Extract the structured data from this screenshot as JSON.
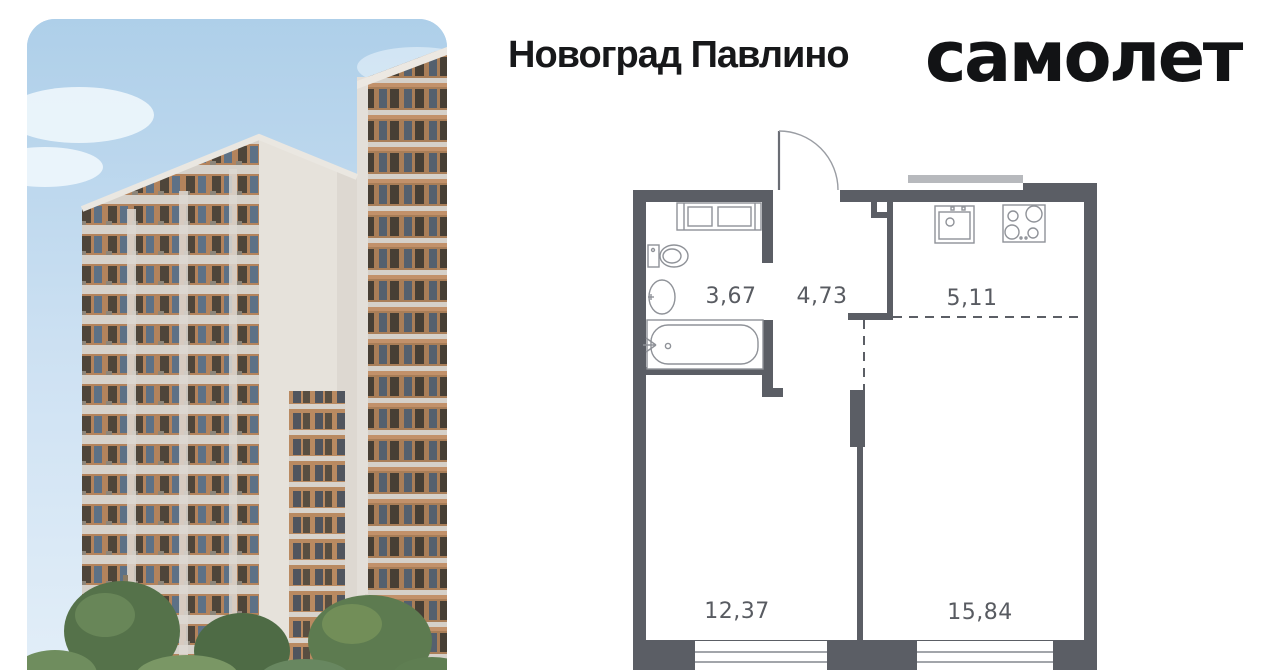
{
  "header": {
    "project_title": "Новоград Павлино",
    "brand_logo": "самолет"
  },
  "floorplan": {
    "rooms": [
      {
        "name": "bathroom",
        "area": "3,67"
      },
      {
        "name": "hallway",
        "area": "4,73"
      },
      {
        "name": "kitchen",
        "area": "5,11"
      },
      {
        "name": "bedroom",
        "area": "12,37"
      },
      {
        "name": "living-room",
        "area": "15,84"
      }
    ],
    "fixtures": [
      "washing-machine-unit",
      "toilet",
      "washbasin",
      "bathtub",
      "kitchen-sink",
      "stove"
    ],
    "features": {
      "entrance_door": true,
      "windows": 2,
      "open_plan_dashed_divider": true
    },
    "colors": {
      "wall": "#5b5e65",
      "fixture_stroke": "#8f9298",
      "label_text": "#585b61",
      "light_bar": "#b7b9bd"
    }
  },
  "photo": {
    "subject": "residential-buildings-render",
    "colors": {
      "sky": "#b0d0ea",
      "facade_white": "#e6e2db",
      "brick": "#c2916a",
      "dark_panel": "#4e453a",
      "trees": "#55724a"
    }
  }
}
